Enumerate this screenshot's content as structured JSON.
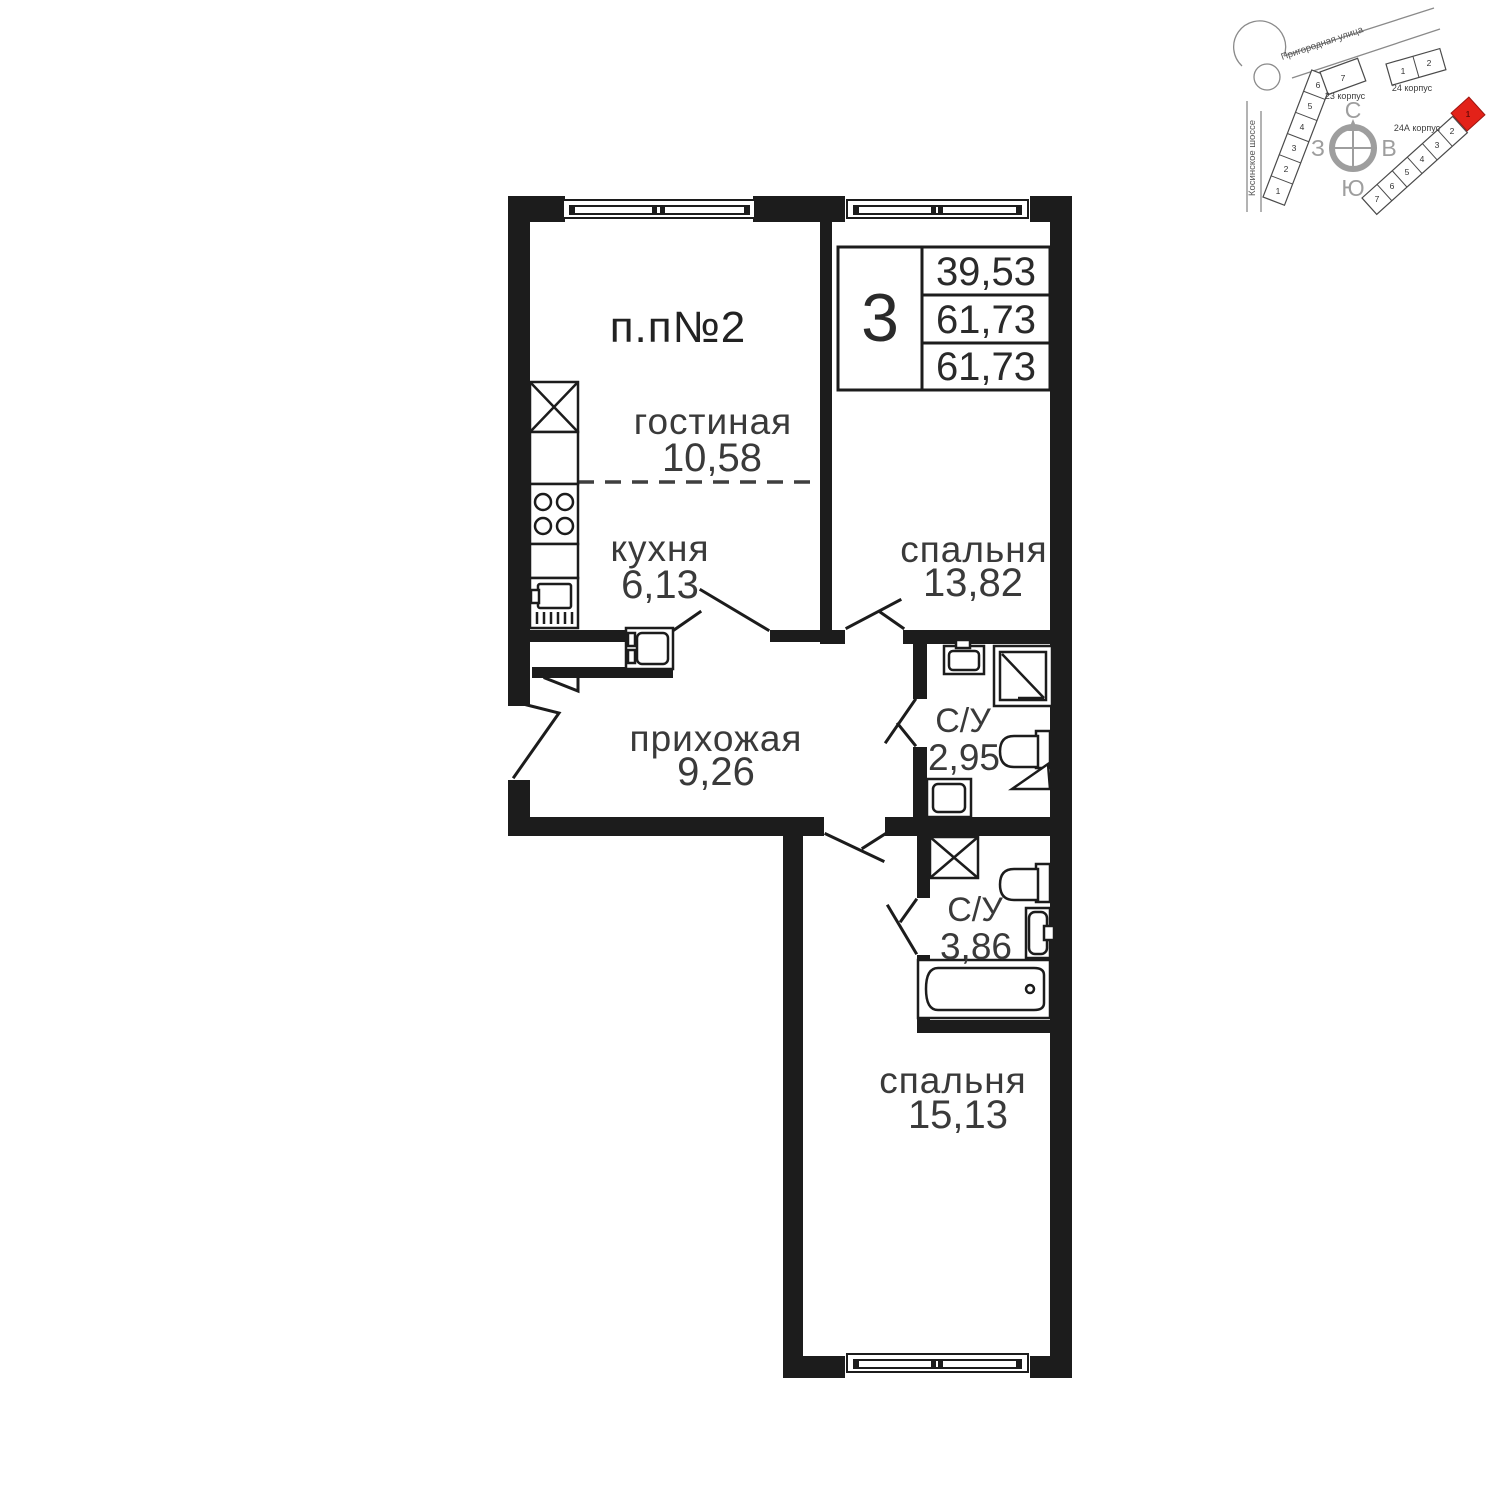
{
  "floorplan": {
    "apartment_label": "п.п№2",
    "info_box": {
      "rooms_count": "3",
      "values": [
        "39,53",
        "61,73",
        "61,73"
      ]
    },
    "rooms": {
      "living": {
        "name": "гостиная",
        "area": "10,58"
      },
      "kitchen": {
        "name": "кухня",
        "area": "6,13"
      },
      "bedroom1": {
        "name": "спальня",
        "area": "13,82"
      },
      "hallway": {
        "name": "прихожая",
        "area": "9,26"
      },
      "bathroom1": {
        "name": "С/У",
        "area": "2,95"
      },
      "bathroom2": {
        "name": "С/У",
        "area": "3,86"
      },
      "bedroom2": {
        "name": "спальня",
        "area": "15,13"
      }
    }
  },
  "sitemap": {
    "streets": {
      "top": "Пригородная улица",
      "left": "Косинское шоссе"
    },
    "compass": {
      "north": "С",
      "south": "Ю",
      "west": "З",
      "east": "В"
    },
    "buildings": {
      "b23": {
        "label": "23 корпус",
        "sections": [
          "1",
          "2",
          "3",
          "4",
          "5",
          "6",
          "7"
        ]
      },
      "b24": {
        "label": "24 корпус",
        "sections": [
          "1",
          "2"
        ]
      },
      "b24a": {
        "label": "24А корпус",
        "sections": [
          "1",
          "2",
          "3",
          "4",
          "5",
          "6",
          "7"
        ],
        "highlighted_section": "1"
      }
    },
    "colors": {
      "highlight": "#e32219"
    }
  }
}
